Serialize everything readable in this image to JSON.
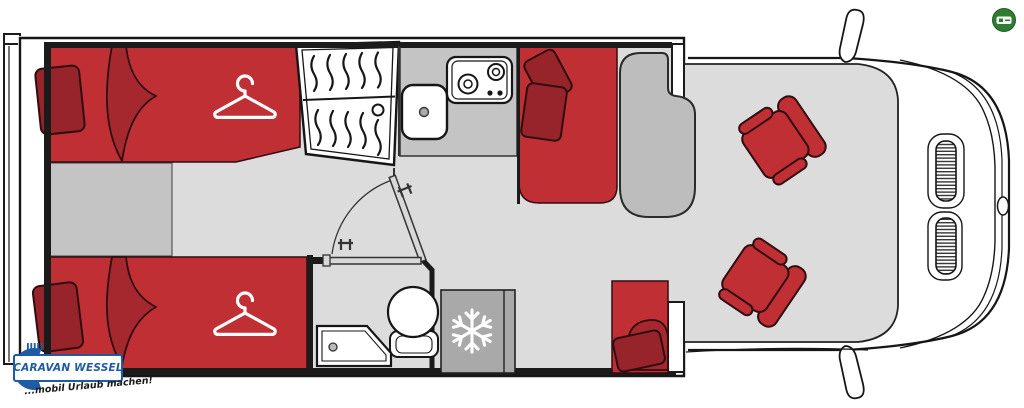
{
  "branding": {
    "logo_text": "CARAVAN WESSEL",
    "tagline": "...mobil Urlaub machen!"
  },
  "colors": {
    "upholstery_red": "#bf2f34",
    "blanket_red": "#a5282e",
    "pillow_red": "#97242a",
    "floor_light": "#dcdcdc",
    "surface_mid": "#c4c4c4",
    "table_gray": "#bdbdbd",
    "fridge_gray": "#a9a9a9",
    "wall_dark": "#1b1b1b",
    "body_white": "#ffffff",
    "logo_blue": "#1d5ba4",
    "badge_green": "#2e7d33",
    "tagline_dark": "#1a1a1a"
  },
  "icons": {
    "wardrobe": "hanger-icon",
    "fridge": "snowflake-icon",
    "corner_badge": "green-emissions-badge-icon"
  }
}
